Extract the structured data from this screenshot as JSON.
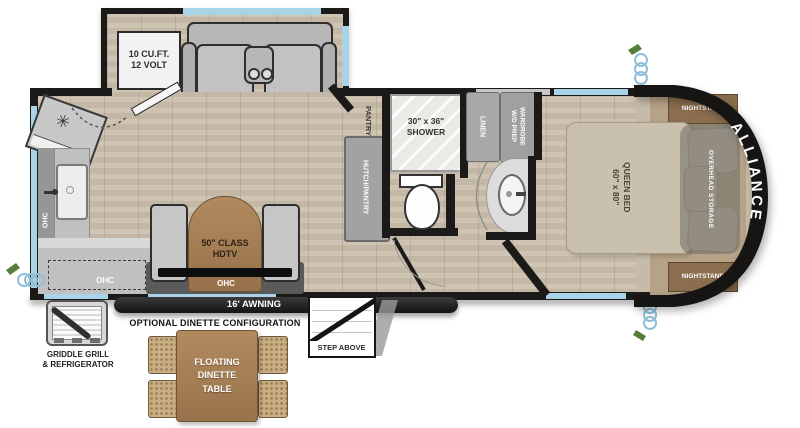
{
  "brand": "ALLIANCE",
  "colors": {
    "wall": "#1c1a19",
    "window_glass": "#a9d3e6",
    "floor_wood": "#cbbfad",
    "counter_gray": "#c0c0c0",
    "cabinet_gray": "#a0a0a0",
    "bed_tan": "#cac0ae",
    "nightstand_brown": "#8a6e4e",
    "table_wood": "#a8825c",
    "wicker_chair": "#c9ae83",
    "front_cap_band": "#171513",
    "label_dark": "#2e2a24",
    "label_light": "#ffffff"
  },
  "labels": {
    "fridge": "10 CU.FT.\n12 VOLT",
    "pantry": "PANTRY",
    "hutch_pantry": "HUTCH/PANTRY",
    "shower": "30\" x 36\"\nSHOWER",
    "linen": "LINEN",
    "wardrobe": "WARDROBE\nW/D PREP",
    "queen_bed": "QUEEN BED\n60\" x 80\"",
    "nightstand": "NIGHTSTAND",
    "overhead_storage": "OVERHEAD STORAGE",
    "tv": "50\" CLASS\nHDTV",
    "ohc": "OHC",
    "awning": "16' AWNING",
    "step": "STEP ABOVE",
    "griddle": "GRIDDLE GRILL\n& REFRIGERATOR",
    "optional_title": "OPTIONAL DINETTE CONFIGURATION",
    "floating_dinette": "FLOATING\nDINETTE\nTABLE"
  }
}
